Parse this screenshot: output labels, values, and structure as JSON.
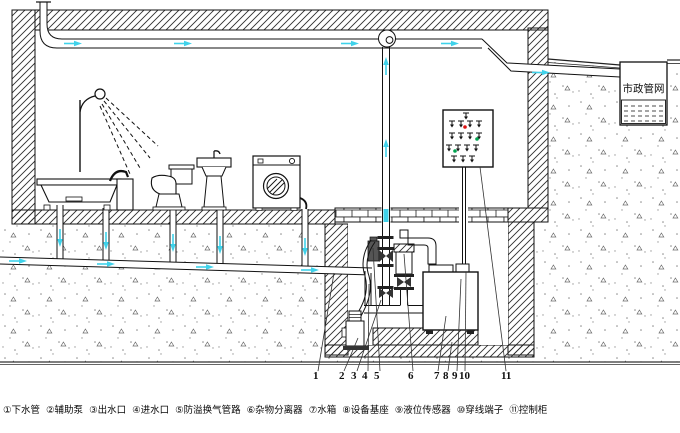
{
  "diagram": {
    "municipal_label": "市政管网",
    "callouts": [
      "1",
      "2",
      "3",
      "4",
      "5",
      "6",
      "7",
      "8",
      "9",
      "10",
      "11"
    ]
  },
  "legend": {
    "items": [
      "①下水管",
      "②辅助泵",
      "③出水口",
      "④进水口",
      "⑤防溢换气管路",
      "⑥杂物分离器",
      "⑦水箱",
      "⑧设备基座",
      "⑨液位传感器",
      "⑩穿线端子",
      "⑪控制柜"
    ]
  },
  "colors": {
    "line": "#111111",
    "flow_arrow": "#3fd2ea",
    "indicator_red": "#dd1111",
    "indicator_green": "#00a550"
  }
}
